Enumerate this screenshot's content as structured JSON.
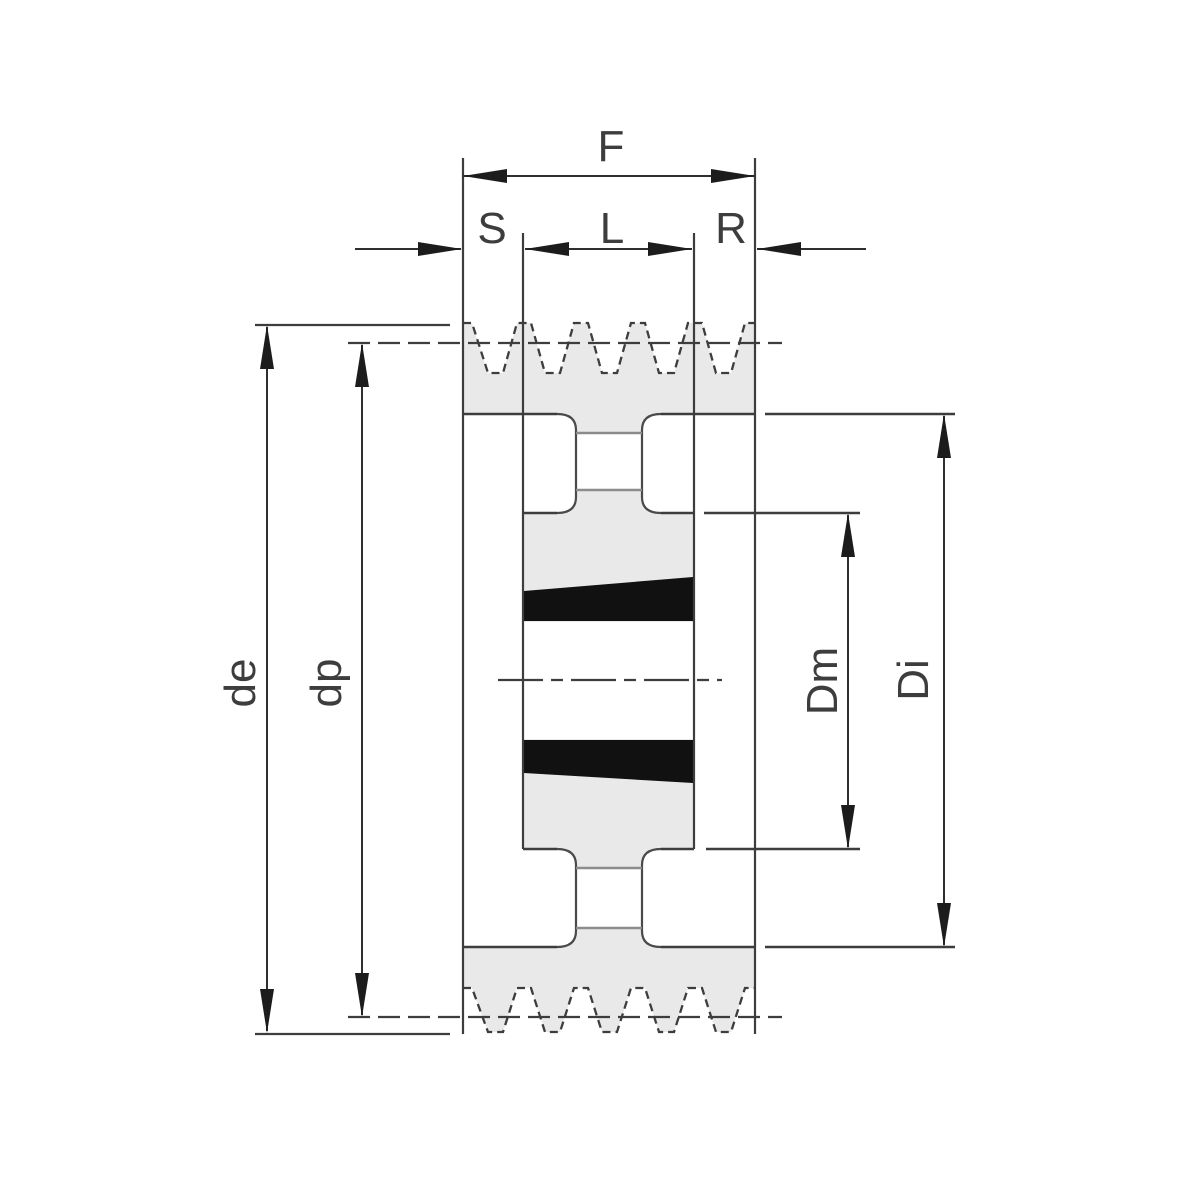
{
  "drawing": {
    "title": "pulley-cross-section",
    "labels": {
      "face_width": "F",
      "offset_left": "S",
      "bushing_length": "L",
      "offset_right": "R",
      "outside_diameter": "de",
      "pitch_diameter": "dp",
      "hub_diameter": "Dm",
      "rim_inner_diameter": "Di"
    },
    "colors": {
      "background": "#ffffff",
      "line": "#3d3d3d",
      "body_fill": "#e9e9e9",
      "wedge_black": "#111111",
      "secondary_line": "#8c8c8c"
    }
  }
}
